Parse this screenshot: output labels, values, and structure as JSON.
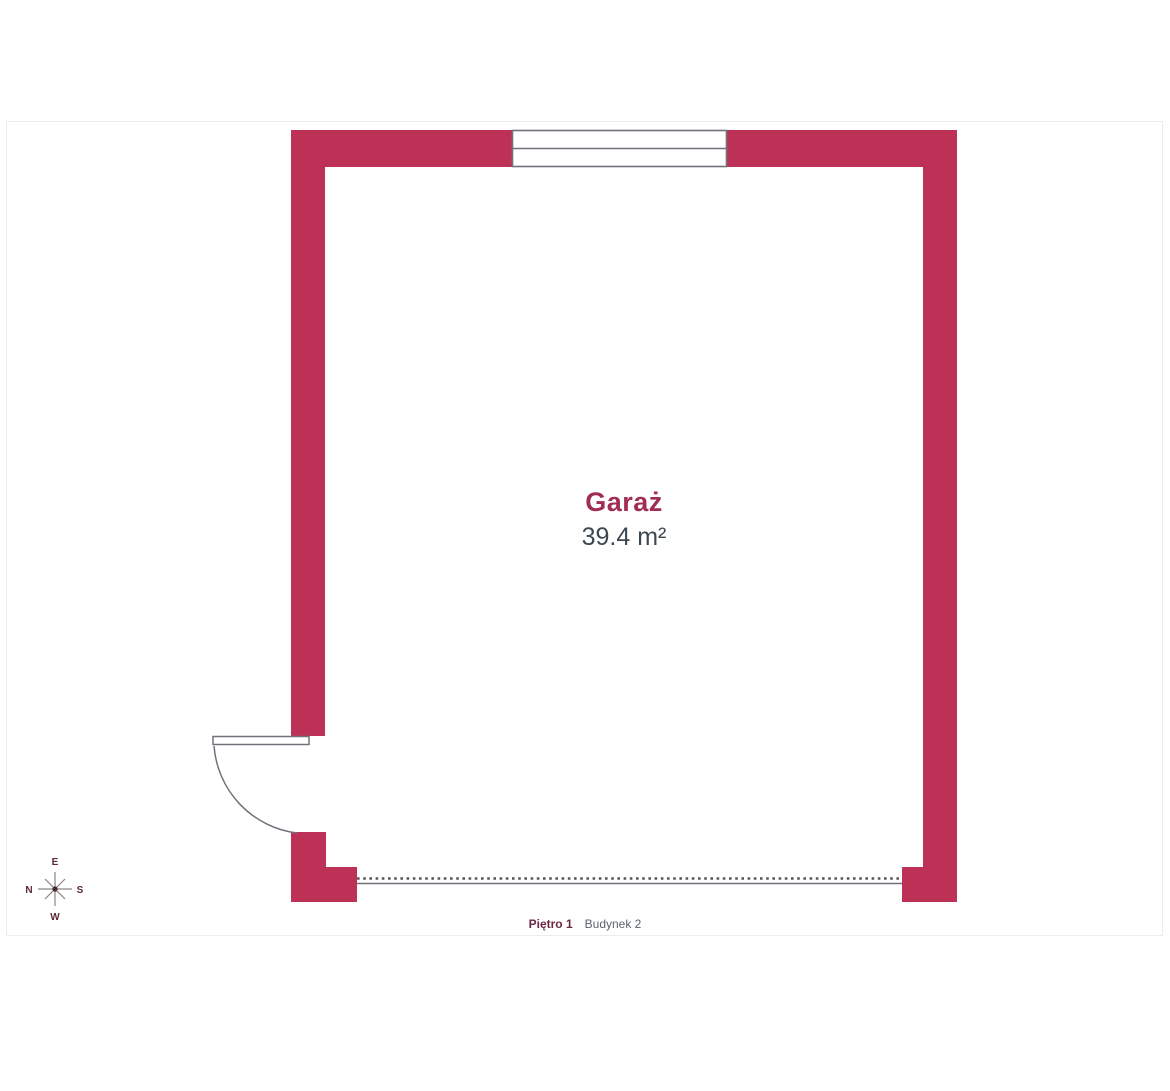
{
  "floorplan": {
    "room": {
      "name": "Garaż",
      "area": "39.4 m²"
    },
    "footer": {
      "floor": "Piętro 1",
      "building": "Budynek 2"
    },
    "compass": {
      "top": "E",
      "left": "N",
      "right": "S",
      "bottom": "W"
    },
    "colors": {
      "wall": "#be3157",
      "room_name_text": "#a12c55",
      "room_area_text": "#3e4852",
      "fixture_lines": "#71717b",
      "opening_dots": "#55555e",
      "frame_border": "#ececec",
      "footer_floor_text": "#6b2742",
      "footer_building_text": "#5c636b",
      "compass_letters": "#5c2a34"
    }
  }
}
